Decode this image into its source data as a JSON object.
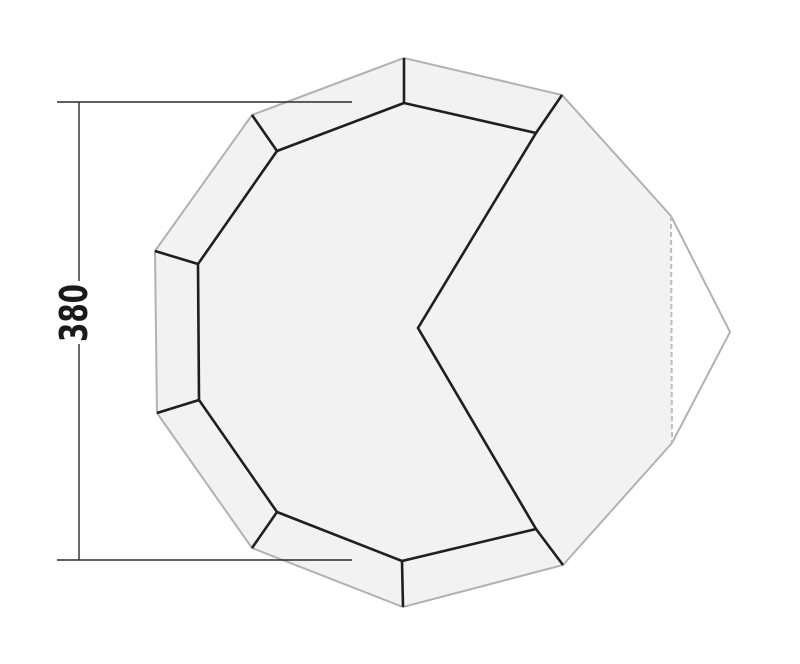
{
  "diagram": {
    "type": "tent-floorplan-top-view",
    "canvas": {
      "width": 800,
      "height": 664,
      "background": "#ffffff"
    },
    "dimension": {
      "label": "380",
      "line_color": "#2b2b2b",
      "line_width": 1.4,
      "text_color": "#1a1a1a",
      "label_font_size": 38,
      "label_text_length": 58,
      "label_pos": {
        "x": 74,
        "y": 313
      },
      "vertical_line": {
        "x": 79,
        "y1": 102,
        "y2": 560,
        "gap_y1": 281,
        "gap_y2": 344
      },
      "top_tick": {
        "y": 102,
        "x1": 57,
        "x2": 352
      },
      "bottom_tick": {
        "y": 560,
        "x1": 57,
        "x2": 352
      }
    },
    "groundsheet": {
      "fill": "#f2f2f2",
      "stroke": "#b2b2b2",
      "stroke_width": 2,
      "vertices": [
        [
          404,
          58
        ],
        [
          562,
          95
        ],
        [
          671,
          216
        ],
        [
          672,
          443
        ],
        [
          563,
          565
        ],
        [
          403,
          607
        ],
        [
          252,
          548
        ],
        [
          157,
          413
        ],
        [
          155,
          251
        ],
        [
          252,
          115
        ]
      ],
      "solid_outline_order": [
        2,
        1,
        0,
        9,
        8,
        7,
        6,
        5,
        4,
        3
      ],
      "dashed_edge": {
        "from": [
          671,
          216
        ],
        "to": [
          672,
          443
        ],
        "stroke": "#bdbdbd",
        "stroke_width": 2,
        "dash": "5 3"
      }
    },
    "door_flap": {
      "fill": "#ffffff",
      "stroke": "#b2b2b2",
      "stroke_width": 2,
      "points": [
        [
          671,
          216
        ],
        [
          730,
          332
        ],
        [
          672,
          443
        ]
      ]
    },
    "inner_tent": {
      "stroke": "#1f1f1f",
      "stroke_width": 2.6,
      "fill": "none",
      "vertices": [
        [
          404,
          103
        ],
        [
          536,
          133
        ],
        [
          418,
          328
        ],
        [
          536,
          529
        ],
        [
          402,
          561
        ],
        [
          277,
          512
        ],
        [
          199,
          400
        ],
        [
          198,
          264
        ],
        [
          277,
          151
        ]
      ]
    },
    "seam_lines": {
      "stroke": "#1f1f1f",
      "stroke_width": 2.6,
      "segments": [
        [
          [
            404,
            58
          ],
          [
            404,
            103
          ]
        ],
        [
          [
            562,
            95
          ],
          [
            536,
            133
          ]
        ],
        [
          [
            563,
            565
          ],
          [
            536,
            529
          ]
        ],
        [
          [
            403,
            607
          ],
          [
            402,
            561
          ]
        ],
        [
          [
            252,
            548
          ],
          [
            277,
            512
          ]
        ],
        [
          [
            157,
            413
          ],
          [
            199,
            400
          ]
        ],
        [
          [
            155,
            251
          ],
          [
            198,
            264
          ]
        ],
        [
          [
            252,
            115
          ],
          [
            277,
            151
          ]
        ]
      ]
    }
  }
}
